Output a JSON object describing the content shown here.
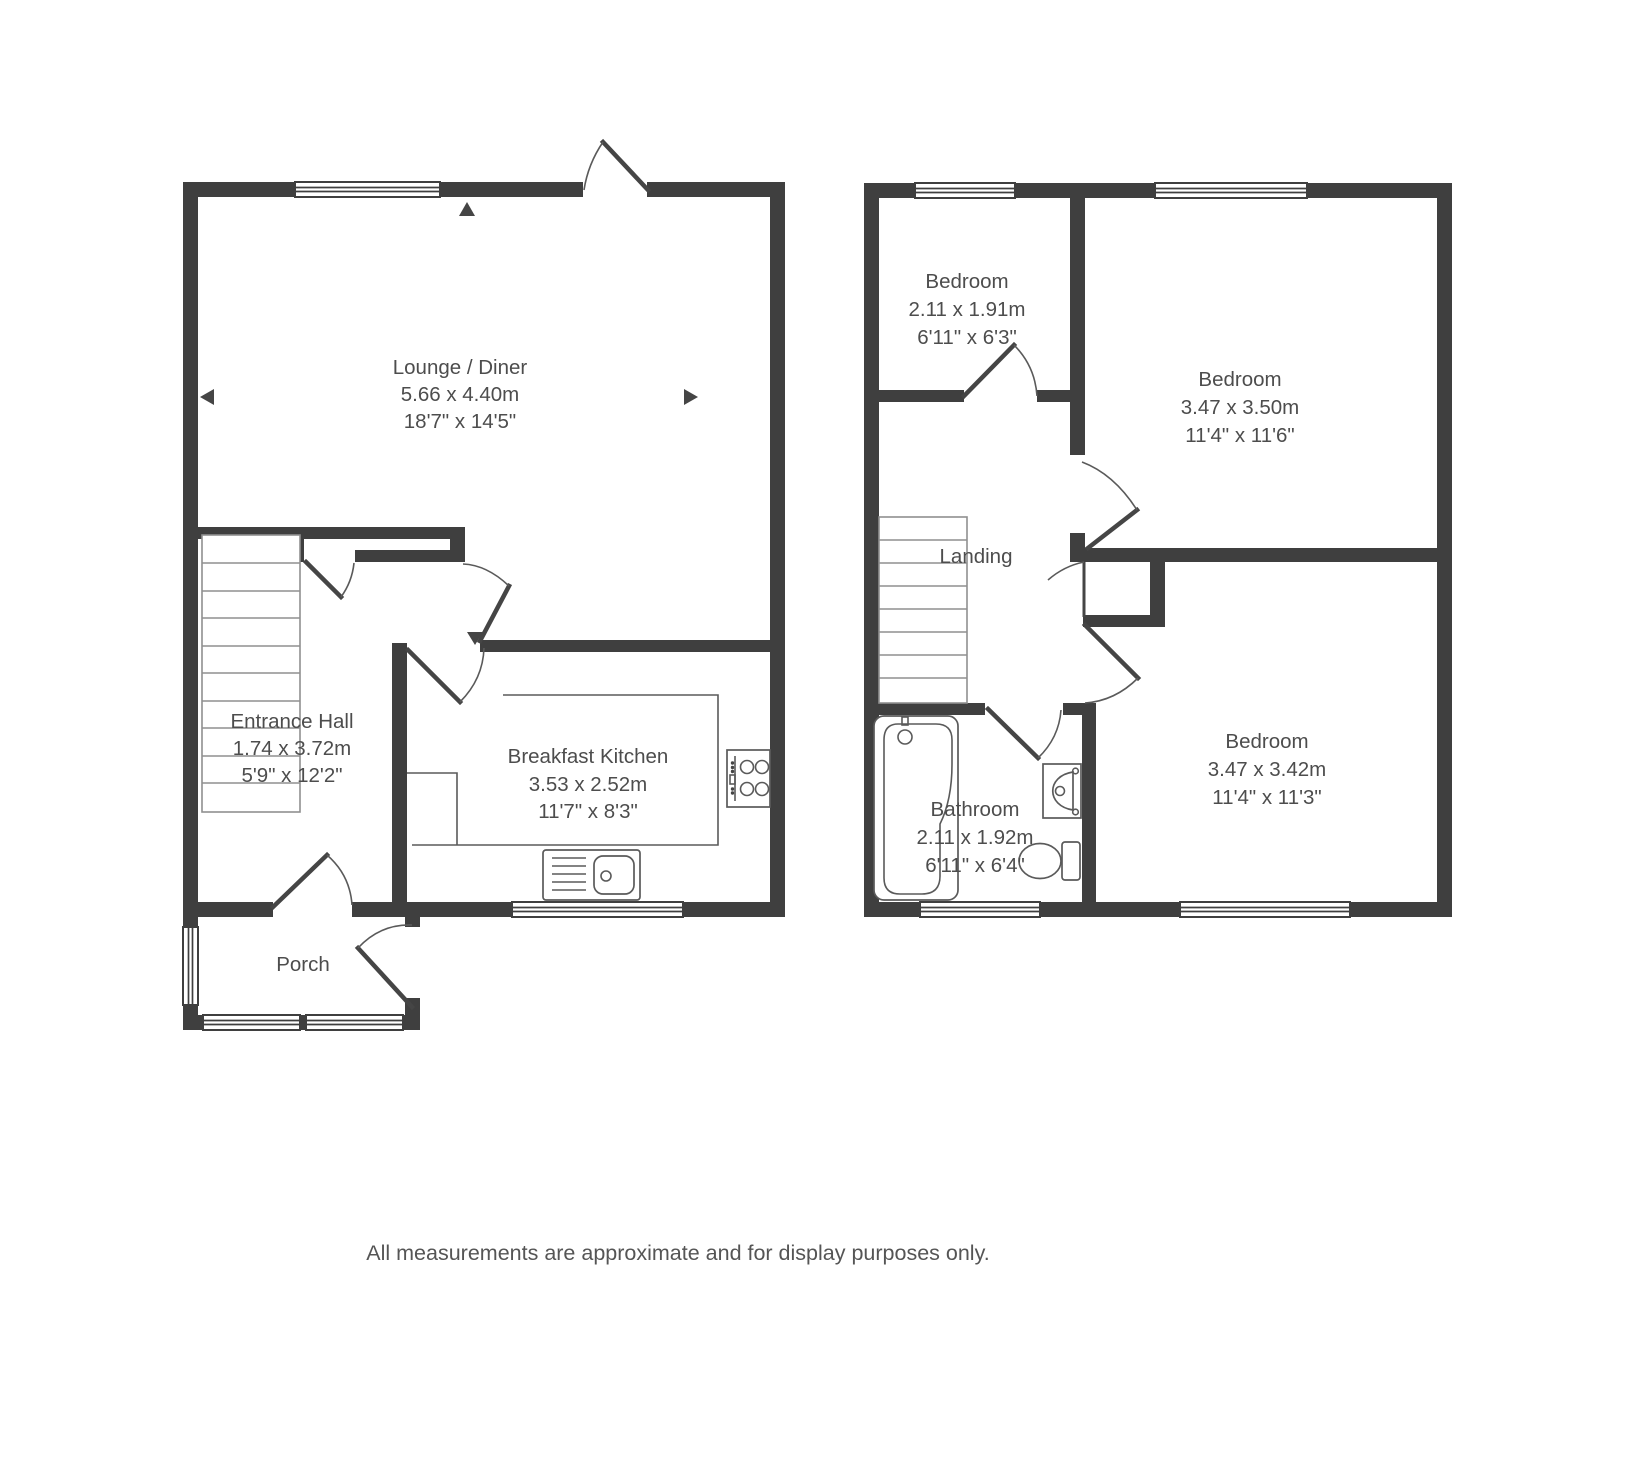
{
  "meta": {
    "wall_color": "#3f3f3f",
    "line_color": "#5a5a5a",
    "text_color": "#4d4d4d"
  },
  "ground_floor": {
    "lounge": {
      "name": "Lounge / Diner",
      "metric": "5.66 x 4.40m",
      "imperial": "18'7\" x 14'5\""
    },
    "entrance_hall": {
      "name": "Entrance Hall",
      "metric": "1.74 x 3.72m",
      "imperial": "5'9\" x 12'2\""
    },
    "kitchen": {
      "name": "Breakfast Kitchen",
      "metric": "3.53 x 2.52m",
      "imperial": "11'7\" x 8'3\""
    },
    "porch": {
      "name": "Porch"
    }
  },
  "first_floor": {
    "bedroom_small": {
      "name": "Bedroom",
      "metric": "2.11 x 1.91m",
      "imperial": "6'11\" x 6'3\""
    },
    "bedroom_rear": {
      "name": "Bedroom",
      "metric": "3.47 x 3.50m",
      "imperial": "11'4\" x 11'6\""
    },
    "bedroom_front": {
      "name": "Bedroom",
      "metric": "3.47 x 3.42m",
      "imperial": "11'4\" x 11'3\""
    },
    "landing": {
      "name": "Landing"
    },
    "bathroom": {
      "name": "Bathroom",
      "metric": "2.11 x 1.92m",
      "imperial": "6'11\" x 6'4\""
    }
  },
  "footer": {
    "disclaimer": "All measurements are approximate and for display purposes only."
  }
}
